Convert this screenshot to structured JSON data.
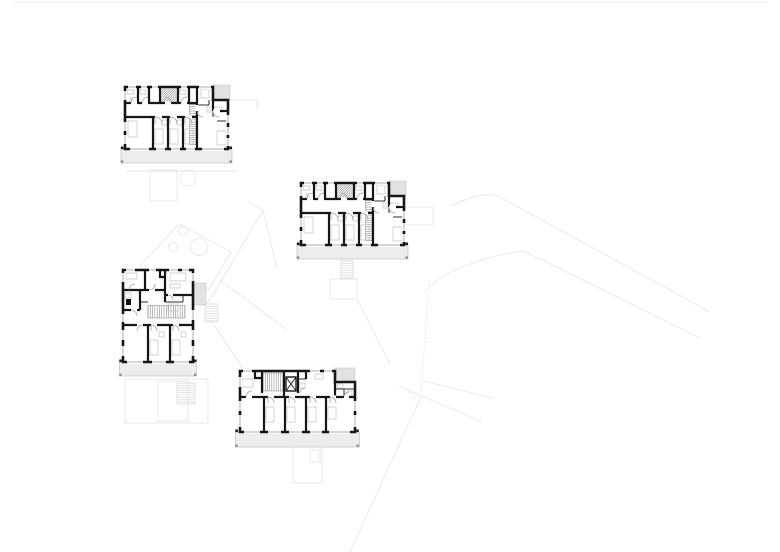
{
  "title": "Architectural site drawing with four apartment floor plans",
  "canvas": {
    "width": 780,
    "height": 552,
    "background": "#ffffff"
  },
  "colors": {
    "wall": "#161616",
    "thin": "#2e2e2e",
    "door": "#9a9a9a",
    "window": "#8f8f8f",
    "fixture": "#c2c2c2",
    "hatch": "#8a8a8a",
    "balconyFill": "#ededed",
    "balconyStroke": "#c9c9c9",
    "patch": "#e2e2e2",
    "site": "#e7e7e7",
    "siteDark": "#dedede",
    "postDark": "#1a1a1a",
    "postGray": "#8f8f8f",
    "solid": "#111111",
    "white": "#ffffff"
  },
  "site": {
    "shapes": [
      {
        "d": "M12,2 H768",
        "sw": 0.8
      },
      {
        "d": "M452,206 Q468,197 484,195 Q492,194 498,196 L710,312"
      },
      {
        "d": "M424,292 Q441,275 462,267 Q495,254 524,251 L700,338"
      },
      {
        "d": "M429,280 L421,393",
        "dash": "2.2,1.6"
      },
      {
        "d": "M396,386 Q414,389 417,407",
        "dash": "2.2,1.6"
      },
      {
        "d": "M421,397 L350,552"
      },
      {
        "d": "M423,381 L493,398"
      },
      {
        "d": "M403,388 Q436,402 482,422"
      },
      {
        "d": "M405,207 H433 V225 H405"
      },
      {
        "d": "M230,100 H257 V110"
      },
      {
        "d": "M150,170 h27 v31 h-27 z"
      },
      {
        "d": "M126,171 H237"
      },
      {
        "circle": [
          188,
          178,
          8
        ]
      },
      {
        "d": "M140,266 L179,224 L231,252 L209,289 L160,285 Z"
      },
      {
        "circle": [
          183,
          231,
          4.5
        ]
      },
      {
        "circle": [
          173,
          247,
          4.5
        ]
      },
      {
        "circle": [
          199,
          247,
          8.5
        ]
      },
      {
        "d": "M248,202 L263,210 L216,290 L207,304"
      },
      {
        "d": "M263,210 L277,268"
      },
      {
        "hatch": {
          "x": 205,
          "y": 304,
          "w": 13,
          "h": 18,
          "dir": "h",
          "step": 2.4
        }
      },
      {
        "d": "M212,322 L244,370"
      },
      {
        "d": "M220,280 L287,330"
      },
      {
        "d": "M330,279 h27 v20 h-27 z"
      },
      {
        "d": "M357,299 L390,364"
      },
      {
        "d": "M125,379 h83 v44 h-83 z"
      },
      {
        "d": "M158,381 h30 v40 h-30 z"
      },
      {
        "hatch": {
          "x": 177,
          "y": 383,
          "w": 18,
          "h": 21,
          "dir": "h",
          "step": 2.4
        }
      },
      {
        "d": "M293,447 h29 v36 h-29 z"
      },
      {
        "d": "M310,450 h10 v12 h-10 z"
      },
      {
        "d": "M341,261 h12 v17 h-12 z"
      },
      {
        "hatch": {
          "x": 341,
          "y": 261,
          "w": 12,
          "h": 17,
          "dir": "h",
          "step": 2.4
        }
      }
    ]
  },
  "geometries": {
    "typeA": {
      "width": 103,
      "height": 62,
      "perimeter": "M0,0 H88 V13 H103 V62 H0 Z",
      "gray_patch": {
        "x": 88,
        "y": -2,
        "w": 17,
        "h": 15
      },
      "balcony": {
        "x": -4,
        "y": 62,
        "w": 111,
        "h": 14
      },
      "thick": [
        "M0,16 H72",
        "M0,30 H72",
        "M72,0 V62",
        "M13,0 V16",
        "M24,0 V16",
        "M35,0 V16",
        "M53,0 V16",
        "M64,0 V16",
        "M28,30 V62",
        "M43,30 V62",
        "M58,30 V62",
        "M88,13 V24",
        "M95,24 H103"
      ],
      "thin": [
        "M72,18 H84",
        "M84,13 V18",
        "M88,24 V30",
        "M92,34 H103"
      ],
      "gaps": [
        [
          30,
          30,
          37,
          30
        ],
        [
          45,
          30,
          52,
          30
        ],
        [
          60,
          30,
          67,
          30
        ],
        [
          6,
          16,
          12,
          16
        ],
        [
          17,
          16,
          23,
          16
        ],
        [
          40,
          16,
          46,
          16
        ],
        [
          56,
          16,
          62,
          16
        ],
        [
          72,
          18,
          72,
          24
        ],
        [
          88,
          24,
          95,
          24
        ]
      ],
      "windows": [
        [
          3,
          0,
          11,
          0
        ],
        [
          16,
          0,
          22,
          0
        ],
        [
          27,
          0,
          33,
          0
        ],
        [
          56,
          0,
          62,
          0
        ],
        [
          74,
          0,
          86,
          0
        ],
        [
          5,
          62,
          24,
          62
        ],
        [
          31,
          62,
          40,
          62
        ],
        [
          46,
          62,
          55,
          62
        ],
        [
          61,
          62,
          70,
          62
        ],
        [
          77,
          62,
          99,
          62
        ],
        [
          0,
          4,
          0,
          13
        ],
        [
          0,
          35,
          0,
          44
        ],
        [
          0,
          48,
          0,
          57
        ],
        [
          103,
          28,
          103,
          36
        ],
        [
          103,
          40,
          103,
          48
        ],
        [
          103,
          51,
          103,
          59
        ]
      ],
      "doors": [
        "M6,16 a6,6 0 0 1 6,-6 M6,16 V10",
        "M17,16 a6,6 0 0 1 6,-6",
        "M46,16 a6,6 0 0 0 -6,-6",
        "M56,16 a6,6 0 0 1 6,-6",
        "M30,30 a7,7 0 0 1 7,7 M30,30 V37",
        "M45,30 a7,7 0 0 1 7,7 M45,30 V37",
        "M60,30 a7,7 0 0 1 7,7 M60,30 V37",
        "M72,24 a6,6 0 0 0 6,6",
        "M88,24 a6,6 0 0 0 6,6"
      ],
      "hatches": [
        {
          "x": 64.5,
          "y": 17.5,
          "w": 6.5,
          "h": 40,
          "dir": "h",
          "step": 2.2
        },
        {
          "x": 35.5,
          "y": 1,
          "w": 17,
          "h": 14,
          "dir": "d",
          "step": 2.4
        }
      ],
      "fixtures": [
        "M30,42 h8 v15 h-8 z",
        "M45,42 h8 v15 h-8 z",
        "M60,42 h8 v15 h-8 z",
        "M3,34 h9 v16 h-9 z",
        "M92,44 h9 v14 h-9 z",
        "M76,2 h8 v9 h-8 z",
        "M37,33 h5 v5 h-5 z",
        "M52,33 h5 v5 h-5 z",
        "M2,3 h7 v4 h-7 z",
        "M15,3 h6 v4 h-6 z",
        "M55,3 h6 v4 h-6 z",
        "M82,20 h15 v5 h-15 z"
      ],
      "posts": [
        {
          "x": -4.2,
          "y": 59.5,
          "w": 2.6,
          "h": 2.6,
          "c": "postDark"
        },
        {
          "x": 104.4,
          "y": 59.5,
          "w": 2.6,
          "h": 2.6,
          "c": "postDark"
        },
        {
          "x": -4.2,
          "y": 73.4,
          "w": 2.4,
          "h": 2.4,
          "c": "postGray"
        },
        {
          "x": 104.6,
          "y": 73.4,
          "w": 2.4,
          "h": 2.4,
          "c": "postGray"
        }
      ]
    },
    "typeC": {
      "width": 115,
      "height": 61,
      "perimeter": "M0,0 H95 V11 H115 V61 H0 Z",
      "gray_patch": {
        "x": 95,
        "y": -3,
        "w": 20,
        "h": 14
      },
      "balcony": {
        "x": -4.5,
        "y": 61,
        "w": 124,
        "h": 15
      },
      "thick": [
        "M0,26 H115",
        "M22,0 V22",
        "M44,0 V26",
        "M58,0 V22",
        "M15,0 V7 H22",
        "M66,0 V8",
        "M24,26 V61",
        "M45,26 V61",
        "M66,26 V61",
        "M86,26 V61",
        "M95,11 V26"
      ],
      "thin": [
        "M95,18 H115",
        "M104,18 V26",
        "M58,8 H66",
        "M46,6 L56,20 M56,6 L46,20"
      ],
      "thin_rects": [
        {
          "x": 46,
          "y": 6,
          "w": 10,
          "h": 14,
          "sw": 1.4
        }
      ],
      "gaps": [
        [
          28,
          26,
          34,
          26
        ],
        [
          49,
          26,
          55,
          26
        ],
        [
          70,
          26,
          76,
          26
        ],
        [
          90,
          26,
          96,
          26
        ],
        [
          6,
          26,
          12,
          26
        ],
        [
          104,
          26,
          109,
          26
        ]
      ],
      "windows": [
        [
          3,
          0,
          12,
          0
        ],
        [
          70,
          0,
          80,
          0
        ],
        [
          84,
          0,
          92,
          0
        ],
        [
          115,
          30,
          115,
          40
        ],
        [
          115,
          44,
          115,
          56
        ],
        [
          0,
          6,
          0,
          16
        ],
        [
          0,
          30,
          0,
          40
        ],
        [
          0,
          44,
          0,
          56
        ],
        [
          4,
          61,
          20,
          61
        ],
        [
          28,
          61,
          41,
          61
        ],
        [
          49,
          61,
          62,
          61
        ],
        [
          70,
          61,
          82,
          61
        ],
        [
          89,
          61,
          110,
          61
        ]
      ],
      "doors": [
        "M6,26 a6,6 0 0 1 6,-6",
        "M28,26 a6,6 0 0 1 6,6 M28,26 V32",
        "M49,26 a6,6 0 0 1 6,6 M49,26 V32",
        "M70,26 a6,6 0 0 1 6,6 M70,26 V32",
        "M90,26 a6,6 0 0 1 6,6 M90,26 V32",
        "M60,22 a5,5 0 0 1 5,-5",
        "M104,26 a5,5 0 0 1 5,-5"
      ],
      "hatches": [
        {
          "x": 23,
          "y": 2,
          "w": 20,
          "h": 18,
          "dir": "v",
          "step": 2.2
        }
      ],
      "fixtures": [
        "M2,8 h11 v8 h-11 z",
        "M26,36 h8 v15 h-8 z",
        "M47,36 h8 v15 h-8 z",
        "M68,36 h8 v15 h-8 z",
        "M88,36 h8 v12 h-8 z",
        "M97,13 h6 v4 h-6 z",
        "M107,20 h5 v5 h-5 z",
        "M60,12 h5 v5 h-5 z",
        "M75,3 h8 v5 h-8 z"
      ],
      "posts": [
        {
          "x": -4.7,
          "y": 58.5,
          "w": 2.6,
          "h": 2.6,
          "c": "postDark"
        },
        {
          "x": 116.2,
          "y": 58.5,
          "w": 2.6,
          "h": 2.6,
          "c": "postDark"
        },
        {
          "x": -4.7,
          "y": 73.5,
          "w": 2.4,
          "h": 2.4,
          "c": "postGray"
        },
        {
          "x": 116.4,
          "y": 73.5,
          "w": 2.4,
          "h": 2.4,
          "c": "postGray"
        }
      ]
    },
    "typeD": {
      "width": 70,
      "height": 92,
      "perimeter": "M0,0 H70 V92 H0 Z",
      "gray_patch": {
        "x": 70,
        "y": 13,
        "w": 13,
        "h": 22
      },
      "balcony": {
        "x": -3.5,
        "y": 92,
        "w": 77,
        "h": 14
      },
      "thick": [
        "M22,0 V20",
        "M42,0 V20",
        "M0,20 H42",
        "M42,25 H70",
        "M17,20 V40",
        "M0,40 H17",
        "M42,20 V32",
        "M37,0 V7 H42",
        "M0,55 H70",
        "M25,55 V92",
        "M47,55 V92"
      ],
      "thin": [
        "M17,32 H25",
        "M42,32 H60",
        "M60,25 V32"
      ],
      "fill_rects": [
        {
          "x": 3,
          "y": 29,
          "w": 5,
          "h": 6
        }
      ],
      "gaps": [
        [
          26,
          20,
          32,
          20
        ],
        [
          45,
          25,
          50,
          25
        ],
        [
          28,
          55,
          34,
          55
        ],
        [
          50,
          55,
          56,
          55
        ],
        [
          14,
          55,
          20,
          55
        ],
        [
          8,
          40,
          14,
          40
        ]
      ],
      "windows": [
        [
          3,
          0,
          12,
          0
        ],
        [
          26,
          0,
          33,
          0
        ],
        [
          46,
          0,
          55,
          0
        ],
        [
          59,
          0,
          66,
          0
        ],
        [
          0,
          3,
          0,
          12
        ],
        [
          0,
          44,
          0,
          52
        ],
        [
          0,
          60,
          0,
          70
        ],
        [
          0,
          76,
          0,
          86
        ],
        [
          70,
          3,
          70,
          11
        ],
        [
          70,
          40,
          70,
          50
        ],
        [
          70,
          60,
          70,
          70
        ],
        [
          70,
          76,
          70,
          86
        ],
        [
          4,
          92,
          20,
          92
        ],
        [
          29,
          92,
          43,
          92
        ],
        [
          51,
          92,
          66,
          92
        ]
      ],
      "doors": [
        "M6,20 a6,6 0 0 1 6,-6",
        "M26,20 a6,6 0 0 0 6,-6",
        "M45,25 a5,5 0 0 1 5,5",
        "M8,40 a6,6 0 0 1 6,6",
        "M28,55 a6,6 0 0 1 6,6 M28,55 V61",
        "M50,55 a6,6 0 0 1 6,6 M50,55 V61",
        "M20,55 a6,6 0 0 0 -6,6"
      ],
      "hatches": [
        {
          "x": 25,
          "y": 35.5,
          "w": 37,
          "h": 12.5,
          "dir": "v",
          "step": 2.3
        }
      ],
      "fixtures": [
        "M3,3 h11 v6 h-11 z",
        "M47,3 h16 v8 h-16 z",
        "M47,14 h10 v4 h-10 z",
        "M27,70 h8 v15 h-8 z",
        "M49,70 h8 v15 h-8 z",
        "M36,62 h5 v5 h-5 z",
        "M58,62 h5 v5 h-5 z",
        "M45,34 h10 v7 h-10 z",
        "M2,23 h6 v5 h-6 z"
      ],
      "posts": [
        {
          "x": -3.7,
          "y": 89.5,
          "w": 2.6,
          "h": 2.6,
          "c": "postDark"
        },
        {
          "x": 70.9,
          "y": 89.5,
          "w": 2.6,
          "h": 2.6,
          "c": "postDark"
        },
        {
          "x": -3.7,
          "y": 103.6,
          "w": 2.4,
          "h": 2.4,
          "c": "postGray"
        },
        {
          "x": 71,
          "y": 103.6,
          "w": 2.4,
          "h": 2.4,
          "c": "postGray"
        }
      ]
    }
  },
  "buildings": [
    {
      "id": "building-1",
      "type": "typeA",
      "x": 125,
      "y": 87
    },
    {
      "id": "building-2",
      "type": "typeA",
      "x": 301,
      "y": 183
    },
    {
      "id": "building-3",
      "type": "typeD",
      "x": 123,
      "y": 270
    },
    {
      "id": "building-4",
      "type": "typeC",
      "x": 240,
      "y": 371
    }
  ]
}
